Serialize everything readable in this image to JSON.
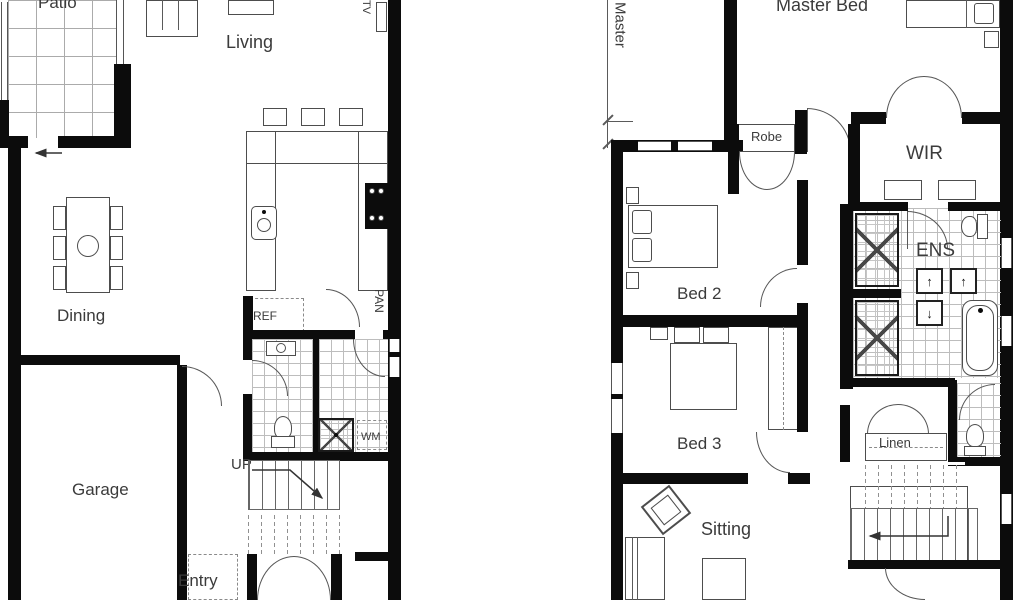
{
  "meta": {
    "type": "floor-plan",
    "description": "Two storey house floor plan, ground floor left and first floor right"
  },
  "ground_floor": {
    "patio": "Patio",
    "living": "Living",
    "tv": "TV",
    "dining": "Dining",
    "ref": "REF",
    "pan": "PAN",
    "wm": "WM",
    "up": "UP",
    "garage": "Garage",
    "entry": "Entry"
  },
  "first_floor": {
    "master_dim": "Master",
    "master_bed": "Master Bed",
    "robe": "Robe",
    "wir": "WIR",
    "ens": "ENS",
    "bed2": "Bed 2",
    "bed3": "Bed 3",
    "linen": "Linen",
    "sitting": "Sitting"
  },
  "colors": {
    "wall": "#0c0c0c",
    "line": "#4d4d4d",
    "tile_line": "#bdbdbd",
    "text": "#3b3b3b",
    "background": "#ffffff"
  }
}
